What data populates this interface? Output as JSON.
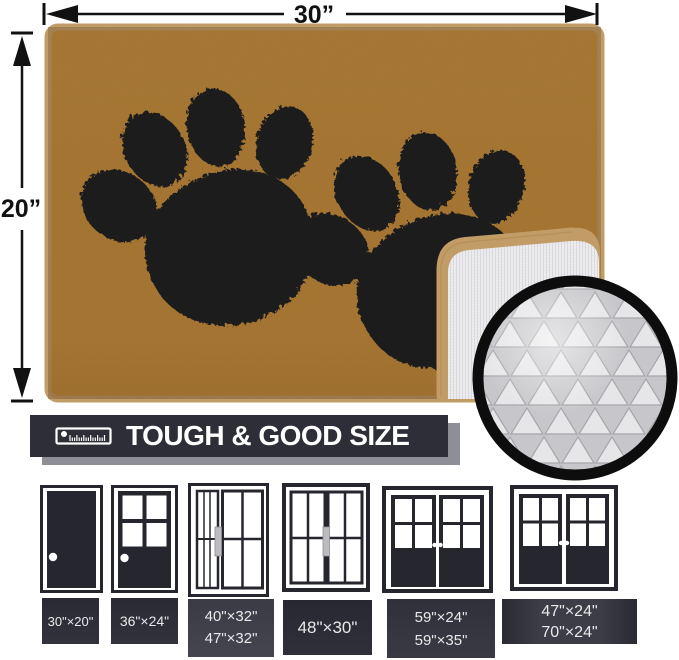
{
  "dimensions": {
    "width_label": "30”",
    "height_label": "20”"
  },
  "banner": {
    "text": "TOUGH & GOOD SIZE",
    "icon": "ruler-icon",
    "bg_color": "#2e2e38",
    "shadow_color": "#8e8e96",
    "text_color": "#ffffff"
  },
  "mat": {
    "fill_color": "#c68e3e",
    "binding_color": "#c29c66",
    "paw_color": "#1c1c1c",
    "backing_color": "#ececee",
    "paw_icon": "paw-print-icon"
  },
  "inset": {
    "ring_color": "#0d0d0d",
    "texture_color": "#d8d8da"
  },
  "doors": [
    {
      "type": "solid-single-door",
      "sizes": [
        "30\"×20\""
      ]
    },
    {
      "type": "half-window-door",
      "sizes": [
        "36\"×24\""
      ]
    },
    {
      "type": "sliding-door-narrow",
      "sizes": [
        "40\"×32\"",
        "47\"×32\""
      ]
    },
    {
      "type": "sliding-door-wide",
      "sizes": [
        "48\"×30\""
      ]
    },
    {
      "type": "double-french-door",
      "sizes": [
        "59\"×24\"",
        "59\"×35\""
      ]
    },
    {
      "type": "double-french-door",
      "sizes": [
        "47\"×24\"",
        "70\"×24\""
      ]
    }
  ]
}
